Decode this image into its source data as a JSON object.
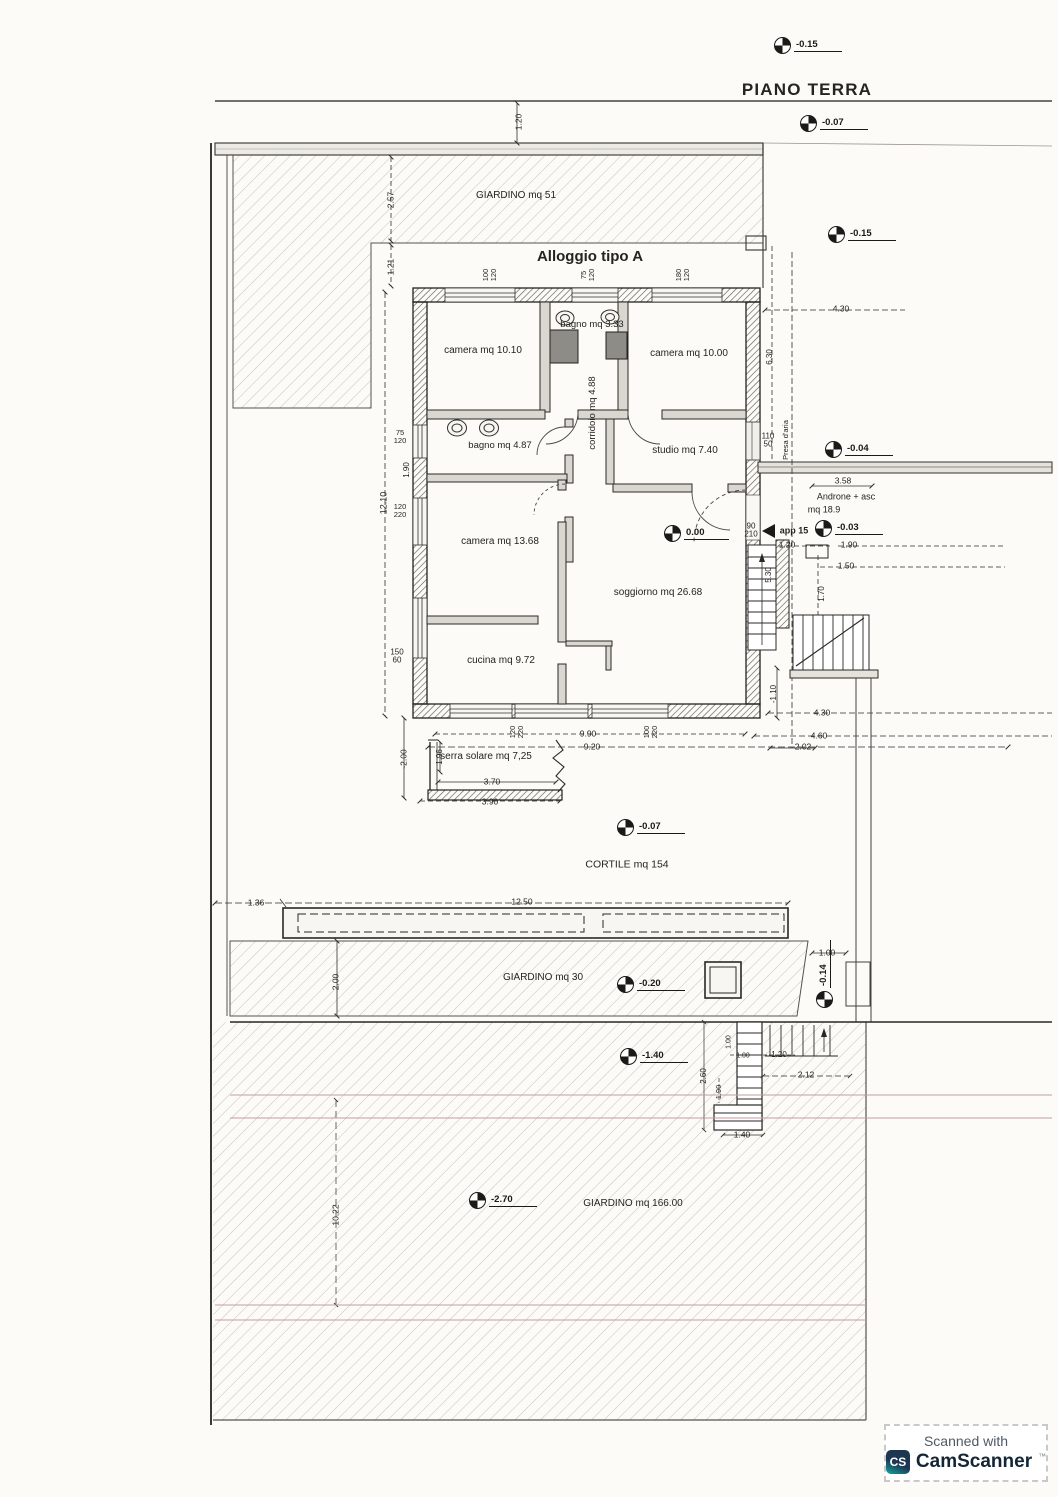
{
  "page": {
    "plan_title": "PIANO TERRA",
    "watermark": {
      "prefix": "Scanned with",
      "brand": "CamScanner",
      "tm": "™",
      "logo_text": "CS"
    }
  },
  "colors": {
    "paper": "#fcfbf8",
    "ink": "#26241f",
    "site_red_line": "#c49c9c",
    "wall_fill": "#e4e2db",
    "camscanner_navy": "#1d3752",
    "camscanner_teal": "#10a7a0"
  },
  "annotations": [
    {
      "name": "page-title",
      "text": "PIANO TERRA",
      "x": 807,
      "y": 90,
      "fs": 17,
      "bold": 1,
      "ls": 1.2
    },
    {
      "name": "plan-title",
      "text": "Alloggio tipo A",
      "x": 590,
      "y": 257,
      "fs": 15,
      "bold": 1
    },
    {
      "name": "area-giardino-51",
      "text": "GIARDINO mq 51",
      "x": 516,
      "y": 196,
      "fs": 10
    },
    {
      "name": "room-camera-1",
      "text": "camera mq 10.10",
      "x": 483,
      "y": 351,
      "fs": 10
    },
    {
      "name": "room-bagno-1",
      "text": "bagno mq 3.33",
      "x": 592,
      "y": 325,
      "fs": 9.5
    },
    {
      "name": "room-camera-2",
      "text": "camera mq 10.00",
      "x": 689,
      "y": 354,
      "fs": 10
    },
    {
      "name": "room-corridoio",
      "text": "corridoio mq 4.88",
      "x": 593,
      "y": 413,
      "fs": 9.5,
      "rot": -90
    },
    {
      "name": "room-bagno-2",
      "text": "bagno mq 4.87",
      "x": 500,
      "y": 446,
      "fs": 9.5
    },
    {
      "name": "room-studio",
      "text": "studio mq 7.40",
      "x": 685,
      "y": 451,
      "fs": 10
    },
    {
      "name": "room-camera-3",
      "text": "camera mq 13.68",
      "x": 500,
      "y": 542,
      "fs": 10
    },
    {
      "name": "room-soggiorno",
      "text": "soggiorno mq 26.68",
      "x": 658,
      "y": 593,
      "fs": 10
    },
    {
      "name": "room-cucina",
      "text": "cucina mq 9.72",
      "x": 501,
      "y": 661,
      "fs": 10
    },
    {
      "name": "room-serra-solare",
      "text": "serra solare mq 7,25",
      "x": 486,
      "y": 757,
      "fs": 10
    },
    {
      "name": "room-androne",
      "text": "Androne + asc",
      "x": 846,
      "y": 497,
      "fs": 9
    },
    {
      "name": "room-androne-area",
      "text": "mq 18.9",
      "x": 824,
      "y": 510,
      "fs": 9
    },
    {
      "name": "label-presa-aria",
      "text": "Presa d'aria",
      "x": 786,
      "y": 440,
      "fs": 7.5,
      "rot": -90
    },
    {
      "name": "label-app-15",
      "text": "app 15",
      "x": 794,
      "y": 531,
      "fs": 9,
      "bold": 1
    },
    {
      "name": "area-cortile",
      "text": "CORTILE mq 154",
      "x": 627,
      "y": 865,
      "fs": 10.5
    },
    {
      "name": "area-giardino-30",
      "text": "GIARDINO mq 30",
      "x": 543,
      "y": 978,
      "fs": 10
    },
    {
      "name": "area-giardino-166",
      "text": "GIARDINO mq 166.00",
      "x": 633,
      "y": 1204,
      "fs": 10
    },
    {
      "name": "dim",
      "text": "1.20",
      "x": 519,
      "y": 122,
      "fs": 8.5,
      "rot": -90
    },
    {
      "name": "dim",
      "text": "2.57",
      "x": 391,
      "y": 200,
      "fs": 8.5,
      "rot": -90
    },
    {
      "name": "dim",
      "text": "1.21",
      "x": 391,
      "y": 267,
      "fs": 8.5,
      "rot": -90
    },
    {
      "name": "dim",
      "text": "12.10",
      "x": 384,
      "y": 503,
      "fs": 9,
      "rot": -90
    },
    {
      "name": "dim-window",
      "text": "75\n120",
      "x": 400,
      "y": 437,
      "fs": 7.5
    },
    {
      "name": "dim",
      "text": "1.90",
      "x": 407,
      "y": 470,
      "fs": 8,
      "rot": -90
    },
    {
      "name": "dim-window",
      "text": "120\n220",
      "x": 400,
      "y": 511,
      "fs": 7.5
    },
    {
      "name": "dim-window",
      "text": "150\n60",
      "x": 397,
      "y": 657,
      "fs": 8
    },
    {
      "name": "dim",
      "text": "-2.00",
      "x": 404,
      "y": 759,
      "fs": 8.5,
      "rot": -90
    },
    {
      "name": "dim",
      "text": "1.96",
      "x": 440,
      "y": 757,
      "fs": 8,
      "rot": -90
    },
    {
      "name": "dim",
      "text": "3.70",
      "x": 492,
      "y": 782,
      "fs": 8.5
    },
    {
      "name": "dim",
      "text": "3.90",
      "x": 490,
      "y": 802,
      "fs": 8.5
    },
    {
      "name": "dim",
      "text": "9.90",
      "x": 588,
      "y": 734,
      "fs": 8.5
    },
    {
      "name": "dim",
      "text": "9.20",
      "x": 592,
      "y": 747,
      "fs": 8.5
    },
    {
      "name": "dim-window",
      "text": "120\n220",
      "x": 517,
      "y": 732,
      "fs": 7.5,
      "rot": -90
    },
    {
      "name": "dim-window",
      "text": "100\n220",
      "x": 651,
      "y": 732,
      "fs": 7.5,
      "rot": -90
    },
    {
      "name": "dim-window",
      "text": "100\n120",
      "x": 490,
      "y": 275,
      "fs": 7.5,
      "rot": -90
    },
    {
      "name": "dim-window",
      "text": "75\n120",
      "x": 588,
      "y": 275,
      "fs": 7.5,
      "rot": -90
    },
    {
      "name": "dim-window",
      "text": "180\n120",
      "x": 683,
      "y": 275,
      "fs": 7.5,
      "rot": -90
    },
    {
      "name": "dim-window",
      "text": "110\n50",
      "x": 768,
      "y": 441,
      "fs": 8
    },
    {
      "name": "dim",
      "text": "3.58",
      "x": 843,
      "y": 481,
      "fs": 8.5
    },
    {
      "name": "dim-door",
      "text": "90\n210",
      "x": 751,
      "y": 531,
      "fs": 8
    },
    {
      "name": "dim",
      "text": "1.20",
      "x": 787,
      "y": 545,
      "fs": 8.5
    },
    {
      "name": "dim",
      "text": "1.90",
      "x": 849,
      "y": 545,
      "fs": 8.5
    },
    {
      "name": "dim",
      "text": "1.50",
      "x": 846,
      "y": 566,
      "fs": 8.5
    },
    {
      "name": "dim",
      "text": "5.30",
      "x": 769,
      "y": 575,
      "fs": 8,
      "rot": -90
    },
    {
      "name": "dim",
      "text": "1.70",
      "x": 822,
      "y": 594,
      "fs": 8,
      "rot": -90
    },
    {
      "name": "dim",
      "text": "-1.10",
      "x": 774,
      "y": 694,
      "fs": 8,
      "rot": -90
    },
    {
      "name": "dim",
      "text": "4.30",
      "x": 841,
      "y": 309,
      "fs": 8.5
    },
    {
      "name": "dim",
      "text": "6.30",
      "x": 770,
      "y": 357,
      "fs": 8,
      "rot": -90
    },
    {
      "name": "dim",
      "text": "4.30",
      "x": 822,
      "y": 713,
      "fs": 8.5
    },
    {
      "name": "dim",
      "text": "4.60",
      "x": 819,
      "y": 736,
      "fs": 8.5
    },
    {
      "name": "dim",
      "text": "2.02",
      "x": 803,
      "y": 747,
      "fs": 8.5
    },
    {
      "name": "dim",
      "text": "1.36",
      "x": 256,
      "y": 903,
      "fs": 8.5
    },
    {
      "name": "dim",
      "text": "12.50",
      "x": 522,
      "y": 902,
      "fs": 8.5
    },
    {
      "name": "dim",
      "text": "2.00",
      "x": 336,
      "y": 982,
      "fs": 8.5,
      "rot": -90
    },
    {
      "name": "dim",
      "text": "1.00",
      "x": 827,
      "y": 953,
      "fs": 8.5
    },
    {
      "name": "dim",
      "text": "1.00",
      "x": 729,
      "y": 1042,
      "fs": 7,
      "rot": -90
    },
    {
      "name": "dim",
      "text": "1.00",
      "x": 743,
      "y": 1056,
      "fs": 7
    },
    {
      "name": "dim",
      "text": "1.20",
      "x": 779,
      "y": 1055,
      "fs": 8
    },
    {
      "name": "dim",
      "text": "2.12",
      "x": 806,
      "y": 1075,
      "fs": 8.5
    },
    {
      "name": "dim",
      "text": "2.60",
      "x": 704,
      "y": 1076,
      "fs": 8,
      "rot": -90
    },
    {
      "name": "dim",
      "text": "1.90",
      "x": 719,
      "y": 1092,
      "fs": 7.5,
      "rot": -90
    },
    {
      "name": "dim",
      "text": "1.40",
      "x": 742,
      "y": 1135,
      "fs": 8.5
    },
    {
      "name": "dim",
      "text": "10.22",
      "x": 336,
      "y": 1215,
      "fs": 8.5,
      "rot": -90
    }
  ],
  "elevation_markers": [
    {
      "value": "-0.15",
      "x": 782,
      "y": 45
    },
    {
      "value": "-0.07",
      "x": 808,
      "y": 123
    },
    {
      "value": "-0.15",
      "x": 836,
      "y": 234
    },
    {
      "value": "-0.04",
      "x": 833,
      "y": 449
    },
    {
      "value": "0.00",
      "x": 672,
      "y": 533
    },
    {
      "value": "-0.03",
      "x": 823,
      "y": 528
    },
    {
      "value": "-0.07",
      "x": 625,
      "y": 827
    },
    {
      "value": "-0.20",
      "x": 625,
      "y": 984
    },
    {
      "value": "-0.14",
      "x": 824,
      "y": 1000,
      "vertical": true
    },
    {
      "value": "-1.40",
      "x": 628,
      "y": 1056
    },
    {
      "value": "-2.70",
      "x": 477,
      "y": 1200
    }
  ]
}
